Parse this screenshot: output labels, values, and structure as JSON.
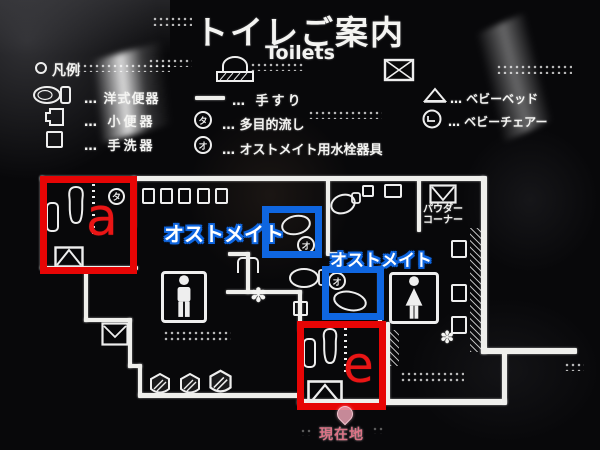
{
  "sign": {
    "title_ja": "トイレご案内",
    "title_en": "Toilets",
    "legend": {
      "heading": "凡例",
      "left": [
        {
          "icon": "western-toilet-icon",
          "label": "… 洋式便器"
        },
        {
          "icon": "urinal-icon",
          "label": "… 小便器"
        },
        {
          "icon": "washbasin-icon",
          "label": "… 手洗器"
        }
      ],
      "middle": [
        {
          "icon": "handrail-icon",
          "label": "… 手すり"
        },
        {
          "icon": "circle-ta-icon",
          "label": "… 多目的流し"
        },
        {
          "icon": "circle-o-icon",
          "label": "… オストメイト用水栓器具"
        }
      ],
      "right": [
        {
          "icon": "baby-bed-icon",
          "label": "… ベビーベッド"
        },
        {
          "icon": "baby-chair-icon",
          "label": "… ベビーチェアー"
        }
      ]
    },
    "map": {
      "powder_corner_line1": "パウダー",
      "powder_corner_line2": "コーナー",
      "current_location": "現在地",
      "circle_ta": "タ",
      "circle_o": "オ",
      "multi_sink_glyph": "✽"
    },
    "annotations": {
      "box_a": "a",
      "box_e": "e",
      "ostomate_1": "オストメイト",
      "ostomate_2": "オストメイト"
    },
    "colors": {
      "annotation_red": "#e60505",
      "annotation_blue": "#0f66e0",
      "letter_red": "#ea1515",
      "line_white": "#efefec",
      "marker_pink": "#e8a0b2"
    }
  }
}
